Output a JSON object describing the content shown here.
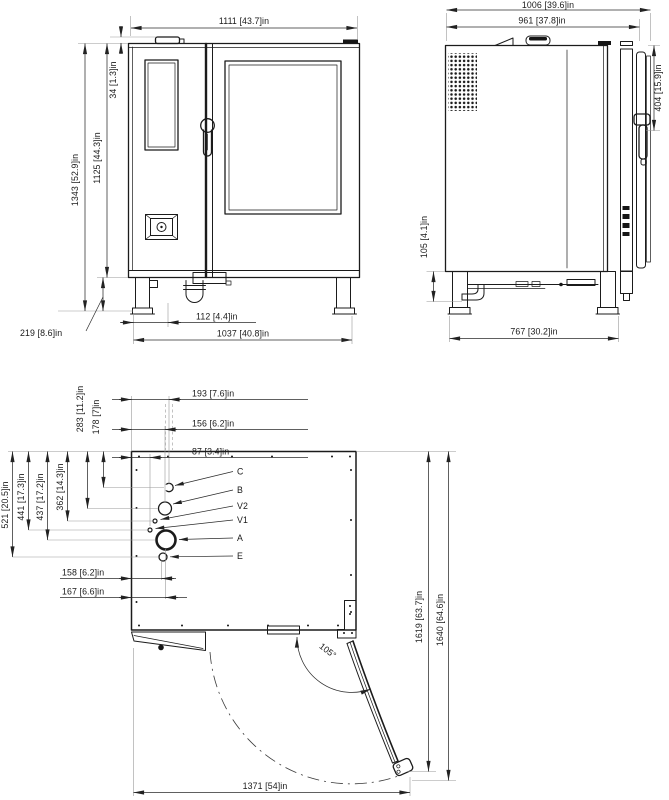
{
  "drawing": {
    "front_view": {
      "dims": {
        "overall_width": "1111  [43.7]in",
        "vent_height": "34  [1.3]in",
        "body_height": "1125  [44.3]in",
        "overall_height": "1343  [52.9]in",
        "leg_height": "219  [8.6]in",
        "drain_offset": "112  [4.4]in",
        "leg_span": "1037  [40.8]in"
      }
    },
    "side_view": {
      "dims": {
        "overall_depth": "1006  [39.6]in",
        "body_depth": "961  [37.8]in",
        "handle_from_top": "404  [15.9]in",
        "clearance_under_body": "105  [4.1]in",
        "leg_span": "767  [30.2]in"
      }
    },
    "plan_view": {
      "dims": {
        "conn_c_from_left": "193  [7.6]in",
        "conn_b_from_left": "156  [6.2]in",
        "conn_v_from_left": "87  [3.4]in",
        "conn_c_from_back": "178  [7]in",
        "conn_b_from_back": "283  [11.2]in",
        "conn_v2_from_back": "362  [14.3]in",
        "conn_a_from_back": "437  [17.2]in",
        "conn_v1_from_back": "441  [17.3]in",
        "conn_e_from_back": "521  [20.5]in",
        "conn_e_from_left": "158  [6.2]in",
        "conn_a_from_left": "167  [6.6]in",
        "depth_door_open": "1619  [63.7]in",
        "depth_door_open_max": "1640  [64.6]in",
        "width_door_open": "1371  [54]in",
        "door_opening_angle": "105°"
      },
      "connection_labels": {
        "c": "C",
        "b": "B",
        "v2": "V2",
        "v1": "V1",
        "a": "A",
        "e": "E"
      }
    }
  }
}
